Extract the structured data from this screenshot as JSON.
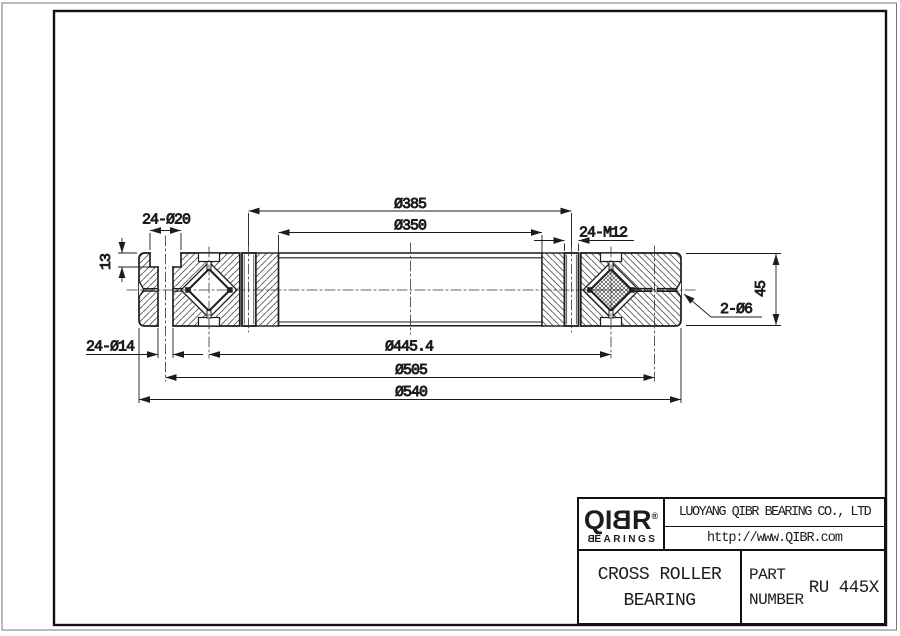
{
  "sheet": {
    "background": "#ffffff",
    "ink": "#1c1c1c"
  },
  "drawing": {
    "dims": {
      "inner_bolt_circle": "Ø385",
      "bore": "Ø350",
      "counterbore_holes": "24-Ø20",
      "counterbore_depth": "13",
      "tapped_holes": "24-M12",
      "through_holes": "24-Ø14",
      "roller_pitch_circle": "Ø445.4",
      "outer_bolt_circle": "Ø505",
      "outer_diameter": "Ø540",
      "grease_holes": "2-Ø6",
      "section_height": "45"
    }
  },
  "title_block": {
    "brand": {
      "letters": [
        "Q",
        "I",
        "B",
        "R"
      ],
      "registered": "®",
      "word_first_letter": "B",
      "word_rest": "EARINGS"
    },
    "company": "LUOYANG QIBR BEARING CO., LTD",
    "website": "http://www.QIBR.com",
    "product_line1": "CROSS ROLLER",
    "product_line2": "BEARING",
    "part_label_line1": "PART",
    "part_label_line2": "NUMBER",
    "part_number": "RU 445X"
  }
}
